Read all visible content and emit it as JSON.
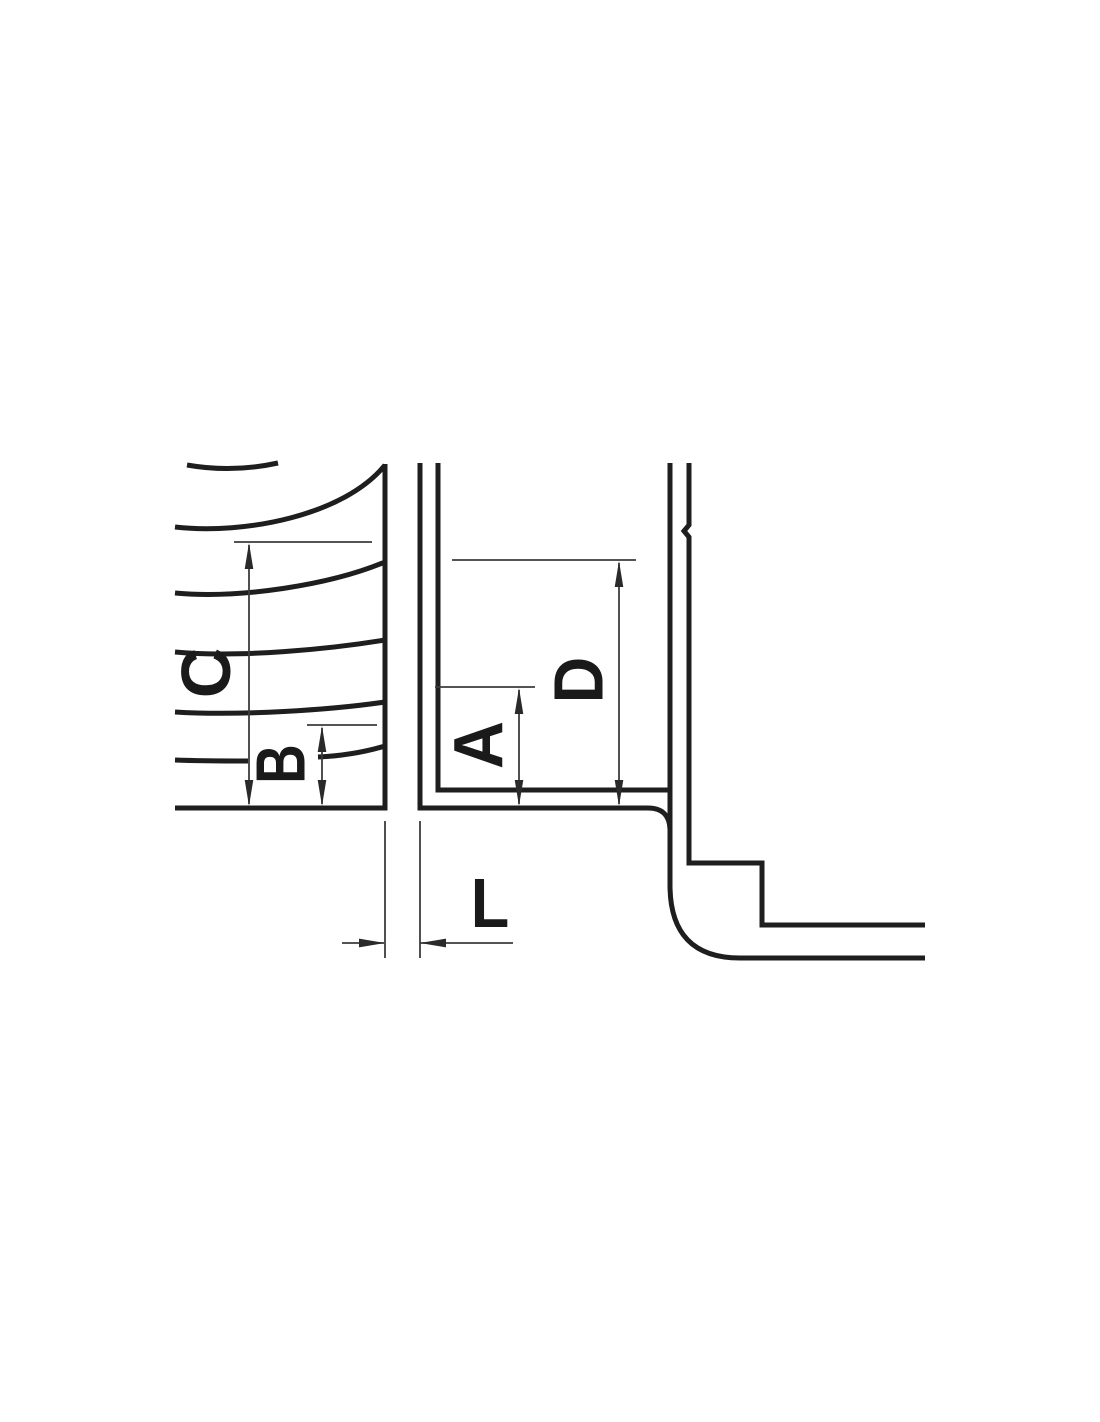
{
  "colors": {
    "background": "#ffffff",
    "part_outline": "#1e1e1e",
    "dimension_line": "#3c3c3c",
    "label_text": "#1a1a1a"
  },
  "dimension_labels": {
    "a": "A",
    "b": "B",
    "c": "C",
    "d": "D",
    "l": "L"
  }
}
